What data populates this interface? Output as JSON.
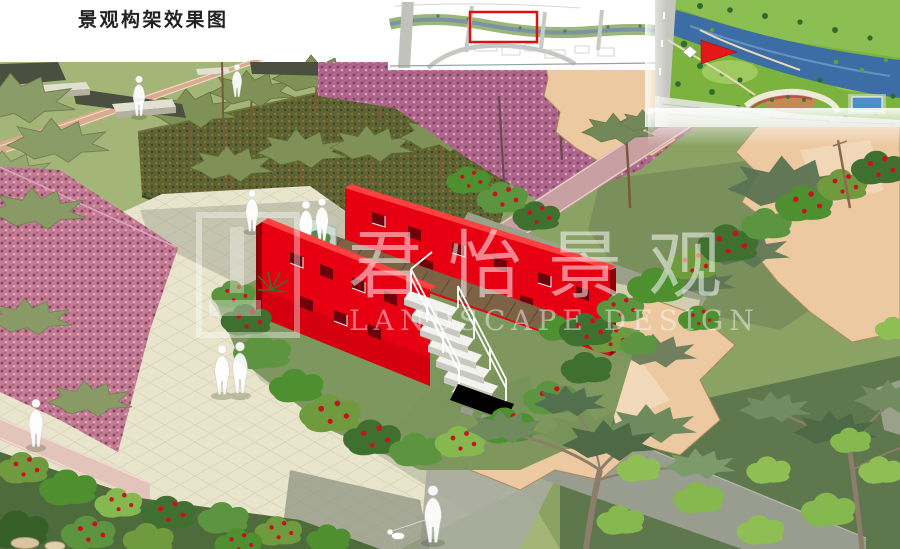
{
  "page": {
    "title": "景观构架效果图"
  },
  "watermark": {
    "chinese": "君怡景观",
    "english": "LANDSCAPE DESIGN"
  },
  "palette": {
    "page_bg": "#ffffff",
    "title_color": "#222222",
    "highlight_red": "#dd1111",
    "structure_red": "#e60012",
    "structure_red_dark": "#8f0008",
    "structure_red_top": "#ff4040",
    "lawn_light": "#a3b677",
    "lawn_mid": "#8aa263",
    "lawn_dark": "#74895a",
    "lawn_forest": "#5f774c",
    "plaza_cream": "#e9e5cd",
    "plaza_shadow": "#9fa391",
    "path_grey": "#999d90",
    "sand_tan": "#ecc9a0",
    "sand_outline": "#a9895f",
    "pink_bed": "#c27b92",
    "pink_blossom": "#b0688f",
    "hedge_dark": "#5e6335",
    "bush_green": "#4e8f30",
    "flower_red": "#cc1022",
    "river_blue": "#3c6da4",
    "plan_green": "#7cb23e",
    "deck_wood": "#7d6245",
    "stair_white": "#f2f2ee"
  }
}
